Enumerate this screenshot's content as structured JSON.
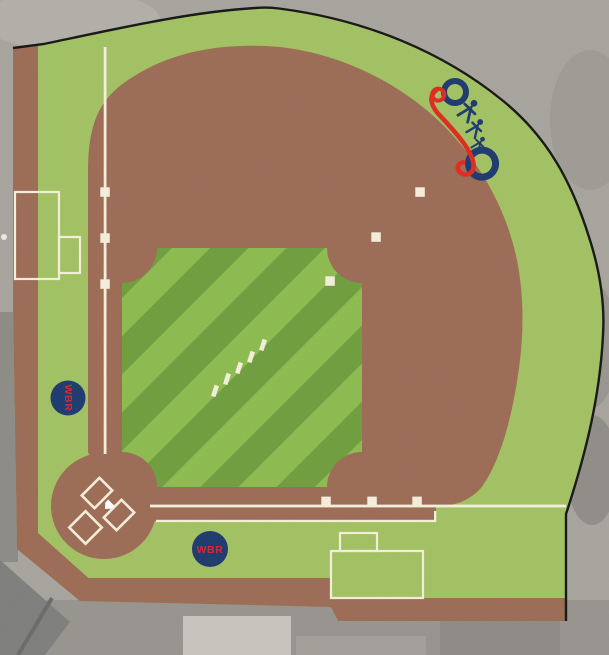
{
  "plan": {
    "subject": "baseball-field-site-plan",
    "badges": {
      "left": {
        "label": "WBR"
      },
      "bottom": {
        "label": "WBR"
      }
    },
    "logo": {
      "name": "wbr-recreation-emblem",
      "colors": {
        "navy": "#1d3a6e",
        "red": "#df2a1f"
      }
    },
    "markers": {
      "base_markers_per_baseline": 3,
      "second_base_markers": 3,
      "pitching_rubber_markers": 5,
      "batters_boxes": 2,
      "catchers_boxes": 1
    },
    "colors": {
      "dirt": "#9c6b55",
      "perimeter_grass": "#a2c162",
      "infield_stripe_light": "#8cbb4f",
      "infield_stripe_dark": "#6f9e3d",
      "foul_line": "#f4eedb",
      "boundary_line": "#161616",
      "aerial_gray": "#a7a49d",
      "badge_navy": "#1d3a6e",
      "badge_text_red": "#d8252c"
    }
  }
}
